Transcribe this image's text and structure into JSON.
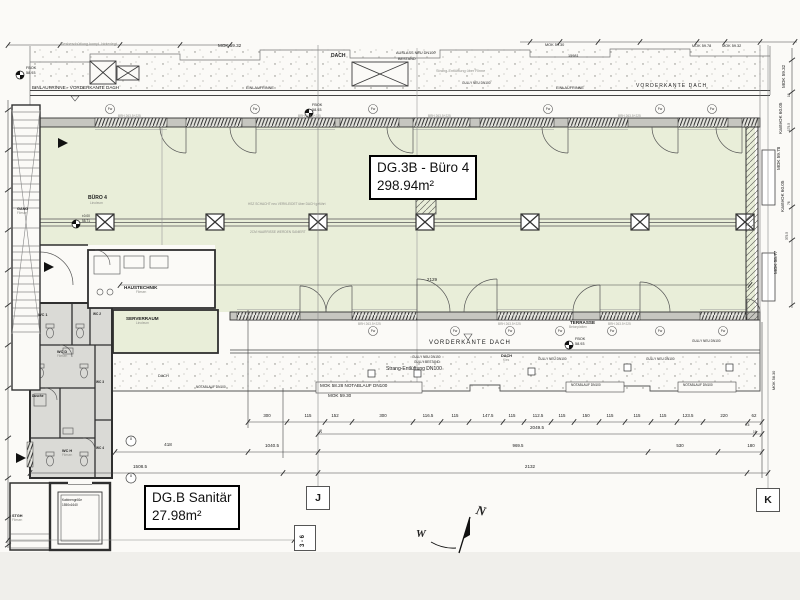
{
  "title_boxes": {
    "buero": {
      "line1": "DG.3B - Büro 4",
      "line2": "298.94m²"
    },
    "sanitaer": {
      "line1": "DG.B Sanitär",
      "line2": "27.98m²"
    }
  },
  "grid": {
    "j": "J",
    "k": "K",
    "axis": "3 - 6"
  },
  "compass": {
    "n": "N",
    "w": "W"
  },
  "rooms": {
    "buero4": {
      "name": "BÜRO 4",
      "sub": "Linoleum"
    },
    "gang": {
      "name": "GANG",
      "sub": "Fliesen"
    },
    "haustechnik": {
      "name": "HAUSTECHNIK",
      "sub": "Fliesen"
    },
    "serverraum": {
      "name": "SERVERRAUM",
      "sub": "Linoleum"
    },
    "wc1": {
      "name": "WC 1"
    },
    "wc2": {
      "name": "WC 2"
    },
    "wcd": {
      "name": "WC D",
      "sub": "Fliesen"
    },
    "wc3": {
      "name": "WC 3"
    },
    "wc4": {
      "name": "WC 4"
    },
    "wch": {
      "name": "WC H",
      "sub": "Fliesen"
    },
    "dusche": {
      "name": "Dusche"
    },
    "stgh": {
      "name": "STGH",
      "sub": "Fliesen"
    },
    "terrasse": {
      "name": "TERRASSE",
      "sub": "Betonplatten"
    },
    "dach": {
      "name": "DACH",
      "sub": "Kies"
    },
    "aufzug": {
      "line1": "Kabinengröße",
      "line2": "1550x1640"
    }
  },
  "annotations": {
    "vorderkante_top_left": "EINLAUFRINNE - VORDERKANTE DACH",
    "einlaufrinne_mid": "EINLAUFRINNE",
    "einlaufrinne_right": "EINLAUFRINNE",
    "vorderkante_top_right": "VORDERKANTE DACH",
    "vorderkante_bottom": "VORDERKANTE DACH",
    "dach_top": "DACH",
    "dach_left": "DACH",
    "auslass": "AUSLASS NEU DN100",
    "bestand": "BESTAND",
    "strang_rinne": "Strang-Entlüftung über Rinne",
    "gully_top": "GULLY NEU DN100",
    "gully_150": "GULLY NEU DN150",
    "gully_bestand": "GULLY BESTAND",
    "strang_dn100": "Strang-Entlüftung DN100",
    "gully_100_a": "GULLY NEU DN100",
    "gully_100_b": "GULLY NEU DN100",
    "gully_100_c": "GULLY NEU DN100",
    "notablauf_a": "NOTABLAUF DN100",
    "notablauf_b": "NOTABLAUF DN100",
    "notablauf_c": "NOTABLAUF DN100",
    "mok_notablauf": "MOK 58.28  NOTABLAUF DN100",
    "schacht_note": "HSZ SCHACHT neu VERKLEIDET über DACH geführt",
    "riss_note": "2CM HAARRISSE WERDEN SANIERT",
    "kies_note": "Kiesbeschüttung kompl. hinterlegt",
    "fenster_marker": "Fw",
    "brh_note": "BRH 263.5+225"
  },
  "levels": {
    "fbok": "FBOK",
    "fbok_v": "58.93",
    "ok_a": "±0.00",
    "ok_b": "58.71",
    "mok_top_l": "MOK 59.32",
    "mok_top_m": "MOK 59.30",
    "mok_top_r1": "MOK 59.78",
    "mok_top_r2": "MOK 59.32",
    "mok_right_v": "MOK 59.32",
    "kante1": "KanteOK 60.05",
    "kante2": "KanteOK 60.05",
    "mok_5978": "MOK 59.78",
    "mok_5877": "MOK 58.77",
    "mok_5930": "MOK 59.30",
    "mok_5830": "MOK 58.30"
  },
  "dims": {
    "row1": [
      {
        "x": 267,
        "v": "300"
      },
      {
        "x": 308,
        "v": "115"
      },
      {
        "x": 335,
        "v": "152"
      },
      {
        "x": 383,
        "v": "300"
      },
      {
        "x": 428,
        "v": "116.5"
      },
      {
        "x": 455,
        "v": "115"
      },
      {
        "x": 488,
        "v": "147.5"
      },
      {
        "x": 512,
        "v": "115"
      },
      {
        "x": 538,
        "v": "112.5"
      },
      {
        "x": 562,
        "v": "115"
      },
      {
        "x": 586,
        "v": "150"
      },
      {
        "x": 610,
        "v": "115"
      },
      {
        "x": 637,
        "v": "115"
      },
      {
        "x": 663,
        "v": "115"
      },
      {
        "x": 688,
        "v": "123.5"
      },
      {
        "x": 724,
        "v": "220"
      },
      {
        "x": 754,
        "v": "62"
      }
    ],
    "row2_total": "2049.5",
    "row2_small": "28",
    "row2_a": "6.5",
    "row2_b": "16",
    "row3": [
      {
        "x": 518,
        "v": "969.5"
      },
      {
        "x": 680,
        "v": "530"
      },
      {
        "x": 751,
        "v": "180"
      }
    ],
    "row3_left": "1040.5",
    "left_418": "418",
    "left_1508": "1508.5",
    "row4_total": "2132",
    "room_width": "2129",
    "top_total": "15981",
    "right_chain": {
      "r1": "16",
      "r2": "179.5",
      "r3": "76",
      "r4": "379.5"
    },
    "pos_a": "8",
    "pos_b": "8"
  }
}
